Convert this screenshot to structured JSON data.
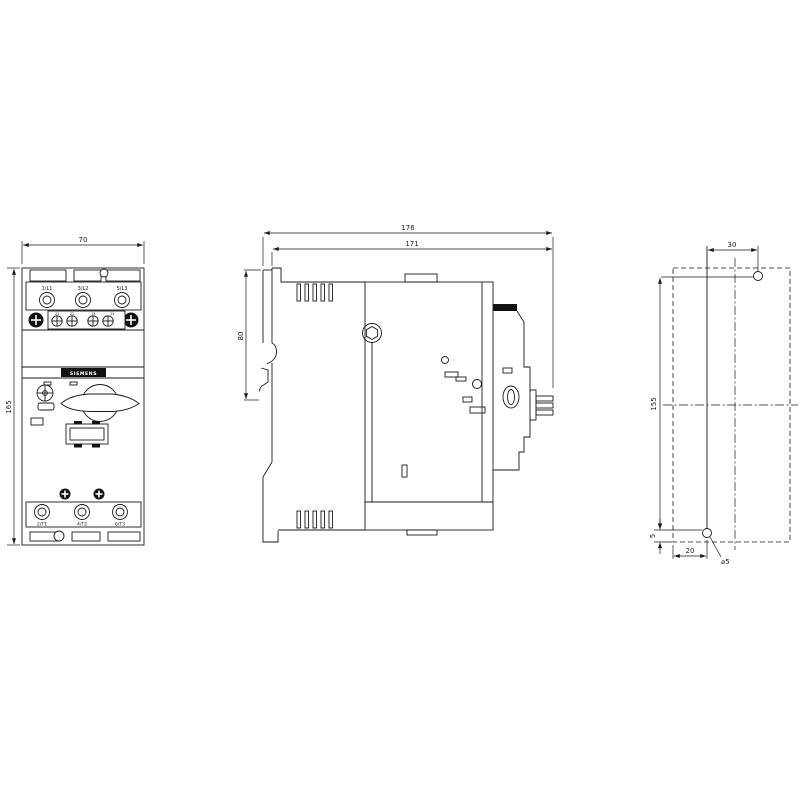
{
  "front_view": {
    "dim_width": "70",
    "dim_height": "165",
    "terminals_top": [
      "1/L1",
      "3/L2",
      "5/L3"
    ],
    "terminals_bottom": [
      "2/T1",
      "4/T2",
      "6/T3"
    ],
    "aux_terminals": [
      "21",
      "22",
      "13",
      "14"
    ],
    "brand": "SIEMENS"
  },
  "side_view": {
    "dim_total_depth": "176",
    "dim_body_depth": "171",
    "dim_top_recess": "80"
  },
  "drill_plan": {
    "dim_hole_offset_x": "30",
    "dim_hole_spacing_y": "155",
    "dim_hole_edge_bottom": "5",
    "dim_hole_edge_left": "20",
    "hole_diameter": "⌀5"
  },
  "colors": {
    "line": "#1a1a1a",
    "background": "#ffffff",
    "fill_dark": "#111111"
  }
}
